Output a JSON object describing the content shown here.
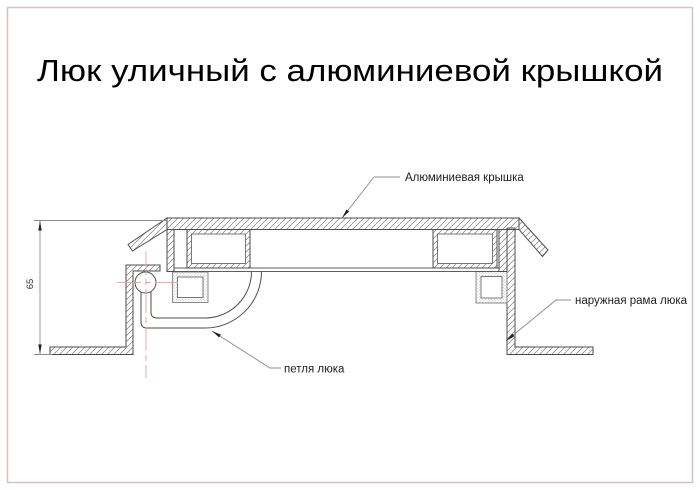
{
  "page": {
    "title": "Люк уличный с алюминиевой крышкой"
  },
  "drawing": {
    "labels": {
      "cover": "Алюминиевая крышка",
      "frame": "наружная рама люка",
      "hinge": "петля люка"
    },
    "dimension": {
      "height_value": "65"
    },
    "colors": {
      "page_border": "#ddbfbf",
      "outline": "#4d4d4d",
      "hatch": "#7f7f7f",
      "centerline": "#e0aea6",
      "leader": "#8c8c8c",
      "text": "#1c1c1c"
    }
  }
}
